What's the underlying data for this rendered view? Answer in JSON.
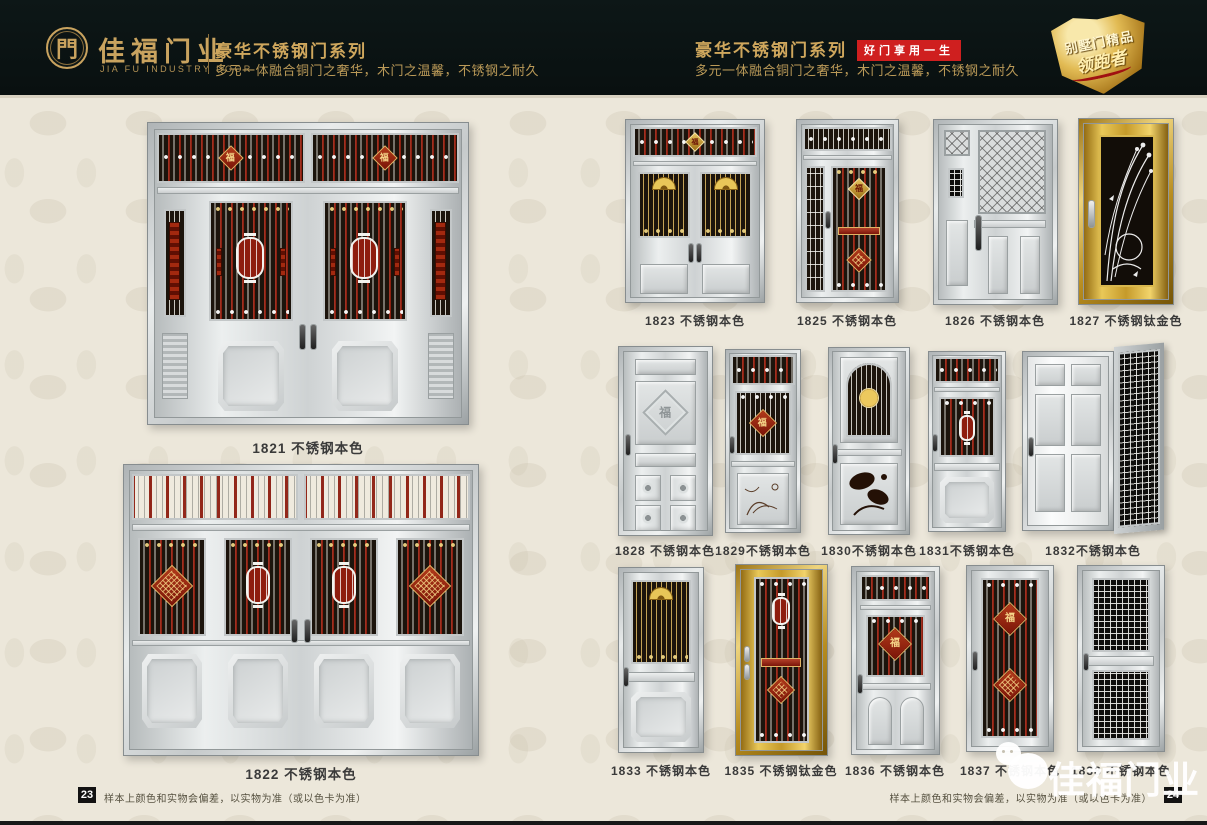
{
  "header": {
    "brand": {
      "logo_glyph": "門",
      "name": "佳福门业",
      "name_en": "JIA FU INDUSTRY DOOR"
    },
    "left": {
      "series_title": "豪华不锈钢门系列",
      "series_subtitle": "多元一体融合铜门之奢华，木门之温馨，不锈钢之耐久"
    },
    "right": {
      "series_title": "豪华不锈钢门系列",
      "slogan_badge": "好门享用一生",
      "series_subtitle": "多元一体融合铜门之奢华，木门之温馨，不锈钢之耐久"
    },
    "shield_badge": {
      "line1": "别墅门精品",
      "line2": "领跑者"
    }
  },
  "ornaments": {
    "fu": "福"
  },
  "left_page": {
    "page_number": "23",
    "disclaimer": "样本上颜色和实物会偏差，以实物为准（或以色卡为准）",
    "doors": [
      {
        "id": "1821",
        "label": "1821 不锈钢本色"
      },
      {
        "id": "1822",
        "label": "1822 不锈钢本色"
      }
    ]
  },
  "right_page": {
    "page_number": "24",
    "disclaimer": "样本上颜色和实物会偏差，以实物为准（或以色卡为准）",
    "rows": [
      {
        "doors": [
          {
            "id": "1823",
            "label": "1823 不锈钢本色"
          },
          {
            "id": "1825",
            "label": "1825 不锈钢本色"
          },
          {
            "id": "1826",
            "label": "1826 不锈钢本色"
          },
          {
            "id": "1827",
            "label": "1827 不锈钢钛金色"
          }
        ]
      },
      {
        "doors": [
          {
            "id": "1828",
            "label": "1828 不锈钢本色"
          },
          {
            "id": "1829",
            "label": "1829不锈钢本色"
          },
          {
            "id": "1830",
            "label": "1830不锈钢本色"
          },
          {
            "id": "1831",
            "label": "1831不锈钢本色"
          },
          {
            "id": "1832",
            "label": "1832不锈钢本色"
          }
        ]
      },
      {
        "doors": [
          {
            "id": "1833",
            "label": "1833 不锈钢本色"
          },
          {
            "id": "1835",
            "label": "1835 不锈钢钛金色"
          },
          {
            "id": "1836",
            "label": "1836 不锈钢本色"
          },
          {
            "id": "1837",
            "label": "1837 不锈钢本色"
          },
          {
            "id": "1838",
            "label": "1838 不锈钢本色"
          }
        ]
      }
    ]
  },
  "watermark": {
    "brand": "佳福门业"
  },
  "colors": {
    "header_bg": "#0B1414",
    "gold": "#C9A35F",
    "badge_red": "#CF1F1F",
    "page_bg": "#ECE7DA",
    "label_text": "#3A3A3A"
  }
}
